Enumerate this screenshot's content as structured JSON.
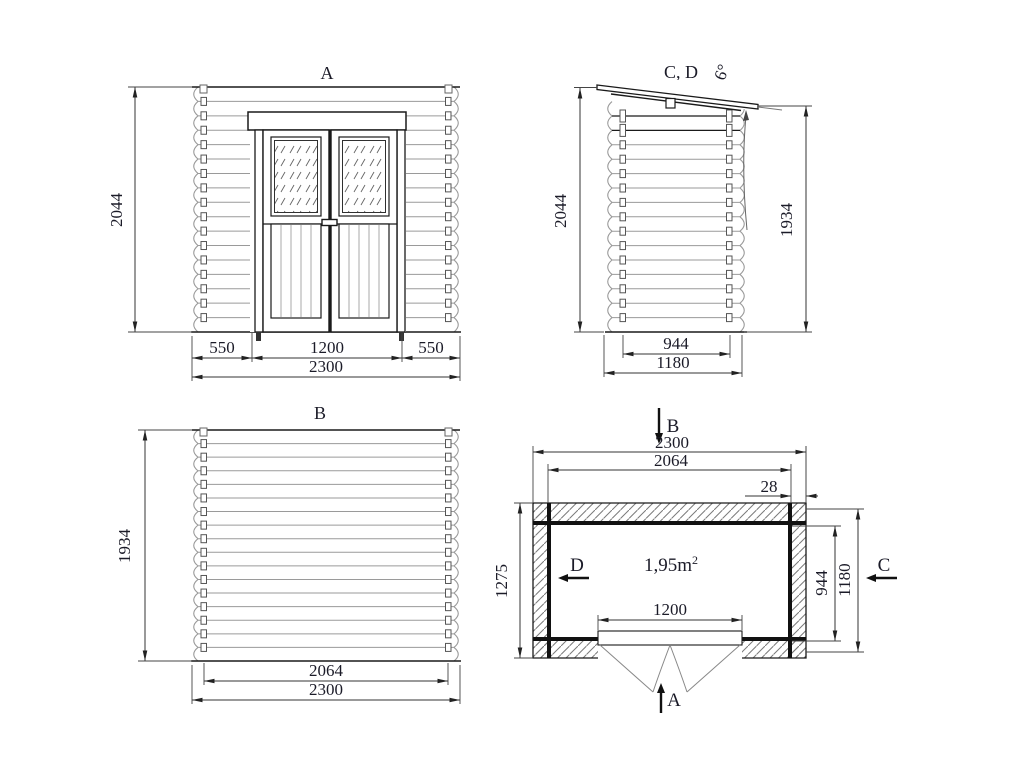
{
  "drawing_title": "log cabin four-view technical drawing",
  "views": {
    "front": {
      "label": "A",
      "height": "2044",
      "left": "550",
      "door": "1200",
      "right": "550",
      "total": "2300"
    },
    "side": {
      "label": "C, D",
      "angle": "6°",
      "height_front": "2044",
      "height_back": "1934",
      "roof_width": "944",
      "total_width": "1180"
    },
    "back": {
      "label": "B",
      "height": "1934",
      "inner": "2064",
      "total": "2300"
    },
    "plan": {
      "section_top": "B",
      "section_bottom": "A",
      "section_left": "D",
      "section_right": "C",
      "total_width": "2300",
      "inner_width": "2064",
      "wall_thickness": "28",
      "depth": "1275",
      "door_width": "1200",
      "inner_depth": "944",
      "outer_depth": "1180",
      "area": "1,95m",
      "area_sup": "2"
    }
  },
  "colors": {
    "line": "#1a1a1a",
    "light": "#9a9a9a",
    "text": "#1b1b28",
    "hatch": "#7a7a7a",
    "dim": "#333333"
  }
}
